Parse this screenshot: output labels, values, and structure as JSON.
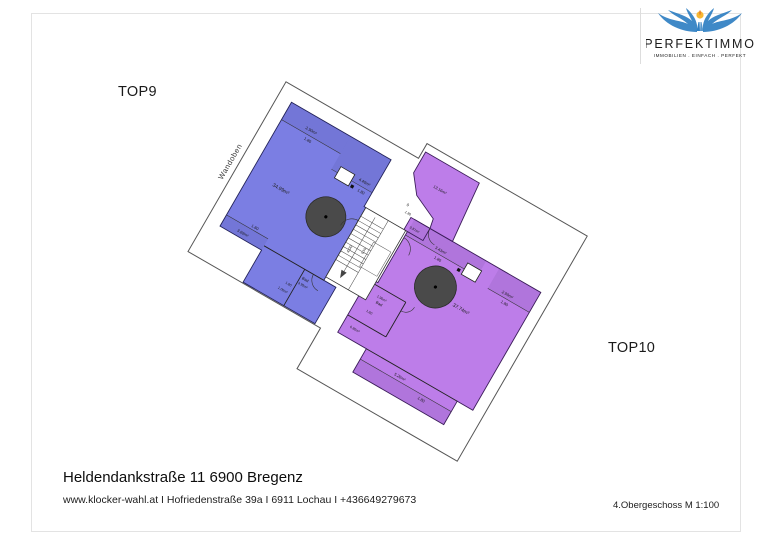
{
  "header": {
    "logo": {
      "brand": "PERFEKTIMMO",
      "tagline": "IMMOBILIEN . EINFACH . PERFEKT",
      "brand_color": "#4f81b8",
      "tagline_color": "#1c3c70",
      "wing_color": "#2f7fc2",
      "sun_color": "#f7b733"
    }
  },
  "plan": {
    "unit_labels": {
      "left": "TOP9",
      "right": "TOP10"
    },
    "annotations": {
      "wall_top": "Wandoben"
    },
    "labels": {
      "blue_area": "34.99m²",
      "blue_strip_tl": "2.90m²",
      "blue_strip_tr": "4.40m²",
      "blue_strip_bl": "3.69m²",
      "blue_bad_name": "Bad",
      "blue_bad_area": "3.99m²",
      "blue_small_area": "1.06m²",
      "dim_180": "1.80",
      "stair_length": "4.00",
      "stair_width": "0.50",
      "purple_top_area": "13.16m²",
      "purple_zero": "0",
      "purple_hall_area": "0.87m²",
      "purple_strip_top": "3.43m²",
      "purple_strip_right": "2.99m²",
      "purple_area": "37.74m²",
      "purple_bad_area": "1.90m²",
      "purple_bad_name": "Bad",
      "purple_small_area": "0.80m²",
      "purple_strip_bottom": "5.26m²"
    },
    "colors": {
      "unit_left_fill": "#7b7ee3",
      "unit_right_fill": "#bd7de9",
      "chimney": "#4a4a4a",
      "roof_outline": "#555555"
    }
  },
  "footer": {
    "address": "Heldendankstraße 11 6900 Bregenz",
    "contact": "www.klocker-wahl.at I Hofriedenstraße 39a I 6911 Lochau I +436649279673",
    "floor_scale": "4.Obergeschoss M 1:100"
  }
}
